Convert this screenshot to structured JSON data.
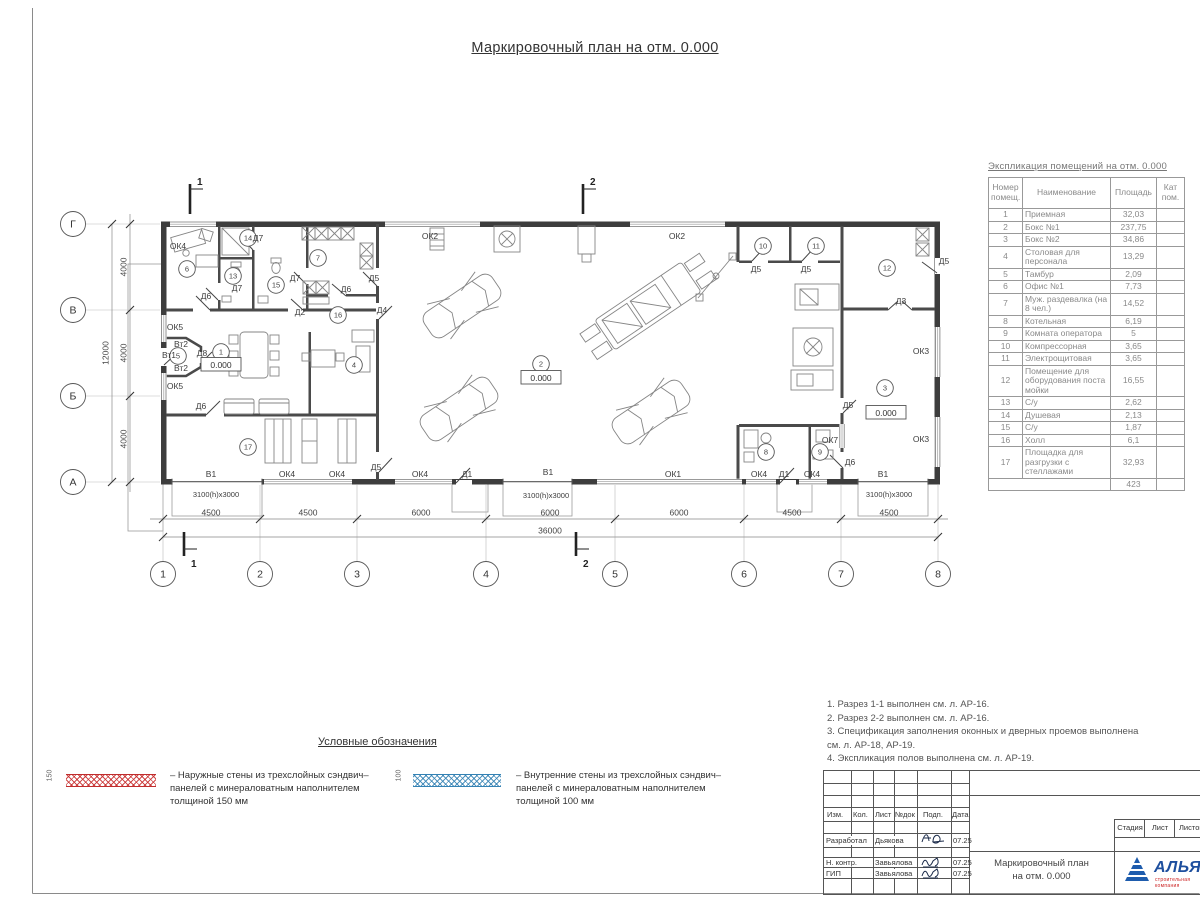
{
  "page": {
    "title": "Маркировочный план на отм. 0.000"
  },
  "explication": {
    "title": "Экспликация помещений на отм. 0.000",
    "headers": {
      "num": "Номер помещ.",
      "name": "Наименование",
      "area": "Площадь",
      "cat": "Кат пом."
    },
    "rows": [
      {
        "num": "1",
        "name": "Приемная",
        "area": "32,03"
      },
      {
        "num": "2",
        "name": "Бокс №1",
        "area": "237,75"
      },
      {
        "num": "3",
        "name": "Бокс №2",
        "area": "34,86"
      },
      {
        "num": "4",
        "name": "Столовая для персонала",
        "area": "13,29"
      },
      {
        "num": "5",
        "name": "Тамбур",
        "area": "2,09"
      },
      {
        "num": "6",
        "name": "Офис №1",
        "area": "7,73"
      },
      {
        "num": "7",
        "name": "Муж. раздевалка (на 8 чел.)",
        "area": "14,52"
      },
      {
        "num": "8",
        "name": "Котельная",
        "area": "6,19"
      },
      {
        "num": "9",
        "name": "Комната оператора",
        "area": "5"
      },
      {
        "num": "10",
        "name": "Компрессорная",
        "area": "3,65"
      },
      {
        "num": "11",
        "name": "Электрощитовая",
        "area": "3,65"
      },
      {
        "num": "12",
        "name": "Помещение для оборудования поста мойки",
        "area": "16,55"
      },
      {
        "num": "13",
        "name": "С/у",
        "area": "2,62"
      },
      {
        "num": "14",
        "name": "Душевая",
        "area": "2,13"
      },
      {
        "num": "15",
        "name": "С/у",
        "area": "1,87"
      },
      {
        "num": "16",
        "name": "Холл",
        "area": "6,1"
      },
      {
        "num": "17",
        "name": "Площадка для разгрузки с стеллажами",
        "area": "32,93"
      }
    ],
    "total": "423"
  },
  "legend": {
    "title": "Условные обозначения",
    "items": [
      {
        "dim": "150",
        "text": "– Наружные стены из трехслойных сэндвич–панелей с минераловатным наполнителем толщиной 150 мм",
        "color": "#c02d2d"
      },
      {
        "dim": "100",
        "text": "– Внутренние стены из трехслойных сэндвич–панелей с минераловатным наполнителем толщиной 100 мм",
        "color": "#3482b4"
      }
    ]
  },
  "notes": [
    "1. Разрез 1-1 выполнен см. л. АР-16.",
    "2. Разрез 2-2 выполнен см. л. АР-16.",
    "3. Спецификация заполнения оконных и дверных проемов выполнена",
    "см. л. АР-18, АР-19.",
    "4. Экспликация полов выполнена см. л. АР-19."
  ],
  "titleblock": {
    "cols": [
      "Изм.",
      "Кол.",
      "Лист",
      "№док",
      "Подп.",
      "Дата"
    ],
    "sign_rows": [
      {
        "role": "Разработал",
        "name": "Дьякова",
        "date": "07.25"
      },
      {
        "role": "Н. контр.",
        "name": "Завьялова",
        "date": "07.25"
      },
      {
        "role": "ГИП",
        "name": "Завьялова",
        "date": "07.25"
      }
    ],
    "stage_cols": [
      "Стадия",
      "Лист",
      "Листов"
    ],
    "doc_title": [
      "Маркировочный план",
      "на отм. 0.000"
    ],
    "logo": {
      "text": "АЛЬЯНС",
      "tagline": "строительная компания"
    }
  },
  "colors": {
    "exterior_wall_legend": "#c02d2d",
    "interior_wall_legend": "#3482b4",
    "logo_blue": "#1e4f9e",
    "logo_red": "#cc2222"
  },
  "plan": {
    "elevation_label": "0.000",
    "gate_size": "3100(h)x3000",
    "grid_letters": [
      {
        "t": "Г",
        "y": 224
      },
      {
        "t": "В",
        "y": 310
      },
      {
        "t": "Б",
        "y": 396
      },
      {
        "t": "А",
        "y": 482
      }
    ],
    "grid_numbers": [
      {
        "t": "1",
        "x": 163
      },
      {
        "t": "2",
        "x": 260
      },
      {
        "t": "3",
        "x": 357
      },
      {
        "t": "4",
        "x": 486
      },
      {
        "t": "5",
        "x": 615
      },
      {
        "t": "6",
        "x": 744
      },
      {
        "t": "7",
        "x": 841
      },
      {
        "t": "8",
        "x": 938
      }
    ],
    "dims_bottom": [
      {
        "t": "4500",
        "x": 211
      },
      {
        "t": "4500",
        "x": 308
      },
      {
        "t": "6000",
        "x": 421
      },
      {
        "t": "6000",
        "x": 550
      },
      {
        "t": "6000",
        "x": 679
      },
      {
        "t": "4500",
        "x": 792
      },
      {
        "t": "4500",
        "x": 889
      }
    ],
    "dim_total_bottom": {
      "t": "36000",
      "x": 550
    },
    "dims_left": [
      {
        "t": "4000",
        "y": 267
      },
      {
        "t": "4000",
        "y": 353
      },
      {
        "t": "4000",
        "y": 439
      }
    ],
    "dim_total_left": {
      "t": "12000",
      "y": 353
    },
    "sections": [
      {
        "t": "1",
        "tx": 190,
        "bx": 184
      },
      {
        "t": "2",
        "tx": 583,
        "bx": 576
      }
    ],
    "elevations": [
      {
        "x": 221,
        "y": 368
      },
      {
        "x": 541,
        "y": 381
      },
      {
        "x": 886,
        "y": 416
      }
    ],
    "rooms": [
      {
        "n": "1",
        "x": 221,
        "y": 352
      },
      {
        "n": "2",
        "x": 541,
        "y": 364
      },
      {
        "n": "3",
        "x": 885,
        "y": 388
      },
      {
        "n": "4",
        "x": 354,
        "y": 365
      },
      {
        "n": "5",
        "x": 178,
        "y": 356
      },
      {
        "n": "6",
        "x": 187,
        "y": 269
      },
      {
        "n": "7",
        "x": 318,
        "y": 258
      },
      {
        "n": "8",
        "x": 766,
        "y": 452
      },
      {
        "n": "9",
        "x": 820,
        "y": 452
      },
      {
        "n": "10",
        "x": 763,
        "y": 246
      },
      {
        "n": "11",
        "x": 816,
        "y": 246
      },
      {
        "n": "12",
        "x": 887,
        "y": 268
      },
      {
        "n": "13",
        "x": 233,
        "y": 276
      },
      {
        "n": "14",
        "x": 248,
        "y": 238
      },
      {
        "n": "15",
        "x": 276,
        "y": 285
      },
      {
        "n": "16",
        "x": 338,
        "y": 315
      },
      {
        "n": "17",
        "x": 248,
        "y": 447
      }
    ],
    "labels": [
      {
        "t": "ОК4",
        "x": 178,
        "y": 249
      },
      {
        "t": "ОК2",
        "x": 430,
        "y": 239
      },
      {
        "t": "ОК2",
        "x": 677,
        "y": 239
      },
      {
        "t": "Д7",
        "x": 258,
        "y": 241
      },
      {
        "t": "Д7",
        "x": 237,
        "y": 291
      },
      {
        "t": "Д7",
        "x": 295,
        "y": 281
      },
      {
        "t": "Д6",
        "x": 206,
        "y": 299
      },
      {
        "t": "Д6",
        "x": 346,
        "y": 292
      },
      {
        "t": "Д6",
        "x": 201,
        "y": 409
      },
      {
        "t": "Д6",
        "x": 850,
        "y": 465
      },
      {
        "t": "Д5",
        "x": 374,
        "y": 281
      },
      {
        "t": "Д5",
        "x": 756,
        "y": 272
      },
      {
        "t": "Д5",
        "x": 806,
        "y": 272
      },
      {
        "t": "Д5",
        "x": 944,
        "y": 264
      },
      {
        "t": "Д5",
        "x": 376,
        "y": 470
      },
      {
        "t": "Д5",
        "x": 848,
        "y": 408
      },
      {
        "t": "Д4",
        "x": 382,
        "y": 313
      },
      {
        "t": "Д2",
        "x": 300,
        "y": 315
      },
      {
        "t": "Д8",
        "x": 202,
        "y": 356
      },
      {
        "t": "Д3",
        "x": 901,
        "y": 304
      },
      {
        "t": "Д1",
        "x": 467,
        "y": 477
      },
      {
        "t": "Д1",
        "x": 784,
        "y": 477
      },
      {
        "t": "Вт2",
        "x": 181,
        "y": 347
      },
      {
        "t": "Вт1",
        "x": 169,
        "y": 358
      },
      {
        "t": "Вт2",
        "x": 181,
        "y": 371
      },
      {
        "t": "ОК5",
        "x": 175,
        "y": 330
      },
      {
        "t": "ОК5",
        "x": 175,
        "y": 389
      },
      {
        "t": "ОК3",
        "x": 921,
        "y": 354
      },
      {
        "t": "ОК3",
        "x": 921,
        "y": 442
      },
      {
        "t": "ОК7",
        "x": 830,
        "y": 443
      },
      {
        "t": "В1",
        "x": 211,
        "y": 477
      },
      {
        "t": "В1",
        "x": 548,
        "y": 475
      },
      {
        "t": "В1",
        "x": 883,
        "y": 477
      },
      {
        "t": "ОК4",
        "x": 287,
        "y": 477
      },
      {
        "t": "ОК4",
        "x": 337,
        "y": 477
      },
      {
        "t": "ОК4",
        "x": 420,
        "y": 477
      },
      {
        "t": "ОК1",
        "x": 673,
        "y": 477
      },
      {
        "t": "ОК4",
        "x": 759,
        "y": 477
      },
      {
        "t": "ОК4",
        "x": 812,
        "y": 477
      },
      {
        "t": "3100(h)x3000",
        "x": 216,
        "y": 497
      },
      {
        "t": "3100(h)x3000",
        "x": 546,
        "y": 498
      },
      {
        "t": "3100(h)x3000",
        "x": 889,
        "y": 497
      }
    ]
  }
}
